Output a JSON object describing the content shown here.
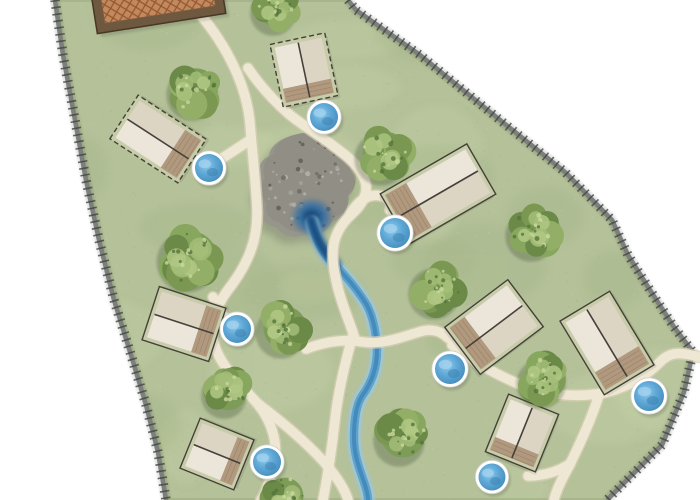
{
  "map": {
    "width": 700,
    "height": 500,
    "colors": {
      "outside": "#ffffff",
      "grass": "#b4c199",
      "grass_dark": "#a4b487",
      "grass_light": "#c8d3a8",
      "grass_edge": "#99a77d",
      "road": "#7c807c",
      "road_tick": "#41443e",
      "path": "#eee7d3",
      "path_edge": "#d8cfb5",
      "stream": "#5ca2cf",
      "stream_edge": "#9ec7de",
      "stream_core": "#3d83b4",
      "spring": "#16497c",
      "rock": "#97968d",
      "rock_dark": "#6e6d65",
      "rock_light": "#b5b4aa",
      "cabin_plot": "#c7cda9",
      "cabin_body_left": "#ece6da",
      "cabin_body_right": "#dcd5c4",
      "cabin_outline": "#45403a",
      "deck": "#b1997f",
      "deck_line": "#937c5e",
      "tub_ring": "#ffffff",
      "tub_light": "#8ecbee",
      "tub_mid": "#5fa8d6",
      "tub_deep": "#3f87b8",
      "lodge_roof": "#c0895e",
      "lodge_hatch": "#96552f",
      "lodge_frame": "#6e5840",
      "lodge_edge": "#483823",
      "tree_shadow": "#3d5030",
      "tree_blobs": [
        "#6b8a48",
        "#88a75e",
        "#7a9852",
        "#93af67"
      ],
      "tree_base": "#7d9c58",
      "tree_highlights": [
        "#a3bd78",
        "#b0c884"
      ],
      "tree_speckles": [
        "#c8d89e",
        "#55743a"
      ]
    },
    "site_polygon": [
      [
        55,
        0
      ],
      [
        348,
        0
      ],
      [
        356,
        10
      ],
      [
        420,
        55
      ],
      [
        500,
        120
      ],
      [
        565,
        172
      ],
      [
        612,
        220
      ],
      [
        628,
        255
      ],
      [
        650,
        290
      ],
      [
        674,
        327
      ],
      [
        693,
        352
      ],
      [
        684,
        392
      ],
      [
        662,
        445
      ],
      [
        630,
        477
      ],
      [
        607,
        500
      ],
      [
        166,
        500
      ],
      [
        158,
        452
      ],
      [
        146,
        405
      ],
      [
        131,
        355
      ],
      [
        114,
        300
      ],
      [
        99,
        240
      ],
      [
        86,
        180
      ],
      [
        75,
        120
      ],
      [
        63,
        55
      ]
    ],
    "road_left": [
      [
        55,
        0
      ],
      [
        63,
        55
      ],
      [
        75,
        120
      ],
      [
        86,
        180
      ],
      [
        99,
        240
      ],
      [
        114,
        300
      ],
      [
        131,
        355
      ],
      [
        146,
        405
      ],
      [
        158,
        452
      ],
      [
        166,
        500
      ]
    ],
    "road_right": [
      [
        348,
        0
      ],
      [
        356,
        10
      ],
      [
        420,
        55
      ],
      [
        500,
        120
      ],
      [
        565,
        172
      ],
      [
        612,
        220
      ],
      [
        628,
        255
      ],
      [
        650,
        290
      ],
      [
        674,
        327
      ],
      [
        693,
        352
      ],
      [
        684,
        392
      ],
      [
        662,
        445
      ],
      [
        630,
        477
      ],
      [
        607,
        500
      ]
    ],
    "walk_paths": [
      "M199,13 C227,46 247,86 250,124 C253,160 256,184 257,210 C258,240 248,263 231,286 C215,306 209,326 214,344 C221,367 241,385 257,403 C271,420 280,444 273,467 C269,486 264,495 261,500",
      "M213,297 C218,310 224,319 233,326",
      "M248,68 C260,86 274,101 290,115 C308,129 325,139 340,151 C355,162 364,173 366,185 C367,195 362,204 354,212 C344,221 337,230 334,243 C331,257 334,274 339,292 C344,310 350,323 354,336",
      "M350,215 C357,201 369,193 381,196 C388,198 391,203 390,210",
      "M306,349 C327,341 346,339 363,342 C382,345 402,337 419,332 C431,328 441,331 448,338",
      "M452,345 C472,361 498,376 524,386 C549,395 574,397 597,394 C620,391 643,379 659,363 C670,351 681,352 699,357",
      "M599,395 C591,420 580,444 569,466 C561,481 556,491 554,500",
      "M570,464 C557,472 543,476 528,476",
      "M257,403 C281,421 305,441 324,462 C337,477 345,489 348,500",
      "M352,338 C345,364 338,392 335,420 C332,448 328,474 323,500",
      "M250,140 C238,148 226,156 216,162"
    ],
    "stream": {
      "main": "M312,222 C316,240 322,252 332,262 C344,274 356,288 365,302 C372,313 376,330 377,350 C377,368 372,382 362,396 C356,405 354,420 354,438 C354,456 360,470 364,482 C367,491 368,496 368,500",
      "source": "M310,218 C316,238 324,252 336,264"
    },
    "spring_pond": {
      "x": 312,
      "y": 217,
      "rx": 22,
      "ry": 20
    },
    "rocks": {
      "outline": "M299,134 C316,130 331,139 337,151 C347,151 353,160 350,170 C358,179 356,191 347,197 C350,208 343,218 332,222 C327,232 316,238 306,234 C295,240 282,236 276,227 C266,226 259,217 262,207 C254,200 254,189 260,181 C256,171 260,160 269,156 C270,144 285,136 299,134 Z",
      "cx": 306,
      "cy": 185,
      "rx": 44,
      "ry": 50
    },
    "cabins": [
      {
        "x": 304,
        "y": 70,
        "long": 64,
        "short": 56,
        "dir": 78,
        "outline": "dashed"
      },
      {
        "x": 158,
        "y": 139,
        "long": 81,
        "short": 52,
        "dir": 33,
        "outline": "dashed"
      },
      {
        "x": 438,
        "y": 194,
        "long": 100,
        "short": 58,
        "dir": 150,
        "outline": "solid"
      },
      {
        "x": 184,
        "y": 324,
        "long": 70,
        "short": 56,
        "dir": 18,
        "outline": "solid"
      },
      {
        "x": 494,
        "y": 327,
        "long": 79,
        "short": 59,
        "dir": 143,
        "outline": "solid"
      },
      {
        "x": 607,
        "y": 343,
        "long": 86,
        "short": 58,
        "dir": 59,
        "outline": "solid"
      },
      {
        "x": 217,
        "y": 454,
        "long": 58,
        "short": 54,
        "dir": 22,
        "outline": "solid"
      },
      {
        "x": 522,
        "y": 433,
        "long": 62,
        "short": 54,
        "dir": 112,
        "outline": "solid"
      }
    ],
    "lodge": {
      "x": 155,
      "y": -18,
      "w": 130,
      "h": 84,
      "rot": -9
    },
    "hot_tubs": [
      [
        324,
        117,
        14
      ],
      [
        209,
        168,
        14
      ],
      [
        395,
        233,
        15
      ],
      [
        237,
        329,
        14
      ],
      [
        450,
        369,
        15
      ],
      [
        649,
        396,
        15
      ],
      [
        267,
        462,
        14
      ],
      [
        492,
        477,
        13.5
      ]
    ],
    "trees": [
      [
        277,
        8,
        24
      ],
      [
        196,
        90,
        27
      ],
      [
        385,
        154,
        28
      ],
      [
        535,
        231,
        27
      ],
      [
        191,
        257,
        32
      ],
      [
        285,
        328,
        27
      ],
      [
        438,
        289,
        27
      ],
      [
        228,
        391,
        24
      ],
      [
        545,
        379,
        26
      ],
      [
        403,
        436,
        27
      ],
      [
        285,
        496,
        23
      ]
    ]
  }
}
